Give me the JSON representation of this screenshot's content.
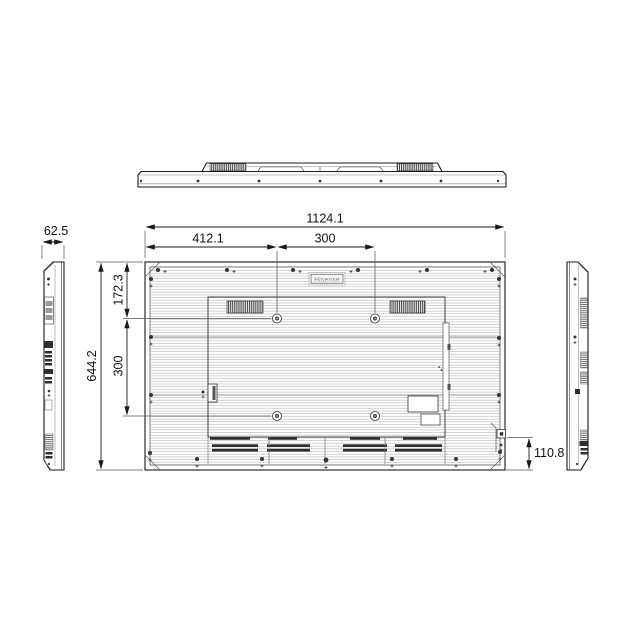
{
  "drawing": {
    "logo_text": "Hisense",
    "colors": {
      "ink": "#1a1a1a",
      "stripe": "#b9b9b9",
      "background": "#ffffff"
    },
    "dimensions": {
      "overall_width": "1124.1",
      "vesa_left_offset": "412.1",
      "vesa_horizontal": "300",
      "depth": "62.5",
      "vesa_top_offset": "172.3",
      "vesa_vertical": "300",
      "overall_height": "644.2",
      "outlet_bottom_offset": "110.8"
    }
  }
}
